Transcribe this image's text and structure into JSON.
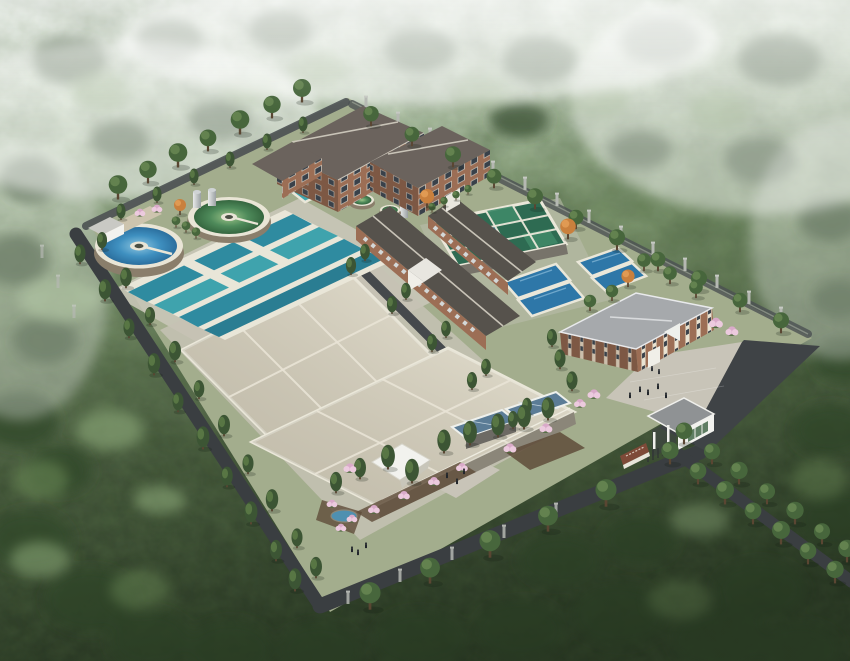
{
  "scene": {
    "description": "Aerial 3D architectural rendering of a water treatment plant campus with circular clarifiers, rectangular treatment basins, covered sedimentation tanks, administration buildings and an entrance gate, surrounded by misty forested hills",
    "elements": {
      "clarifier_blue": "circular clarifier tank with blue water",
      "clarifier_green": "circular clarifier tank with green water",
      "teal_basins": "open rectangular treatment basins with teal water",
      "covered_basins": "large beige-roofed covered basins",
      "filter_grid": "filter basin grid with green water cells",
      "pool_basins": "small rectangular basins with blue water",
      "main_building": "three-storey brick process building",
      "annex_building": "two-storey brick annex",
      "long_buildings": "long gable-roofed process buildings",
      "admin_building": "two-storey brick administration building with hip roof",
      "gatehouse": "white entrance gatehouse",
      "gate_sign": "brown entrance sign wall",
      "white_canopy": "small white canopy structure",
      "perimeter_fence": "concrete post perimeter fence",
      "roads": "dark asphalt perimeter and access roads",
      "forest": "surrounding forested hillside with mist"
    }
  },
  "colors": {
    "haze": "#ecf2ec",
    "forest_top": "#c7d7c0",
    "forest_mid": "#7e9670",
    "forest_dark": "#44553b",
    "forest_deep": "#2e3d28",
    "canopy_dark": "#33492a",
    "canopy_light": "#6d8c58",
    "meadow": "#93b07f",
    "mist": "#ffffff",
    "ground": "#a3ad8d",
    "apron": "#c9c6b8",
    "road": "#3a3e41",
    "parking": "#3f4346",
    "plaza": "#c8c4b8",
    "water_teal": "#2f8ba0",
    "water_teal2": "#3fa3ad",
    "water_deep": "#2a7d92",
    "pool_blue": "#2e77a8",
    "steel_blue": "#5b7c96",
    "pond": "#4f90b0",
    "grid_green": "#2e6b52",
    "cell_hi": "#3f8a68",
    "cell_teal": "#35788a",
    "clar_blue_light": "#8ec6e0",
    "clar_blue": "#3f90c0",
    "clar_blue_deep": "#2b6f9e",
    "clar_green_light": "#9cc488",
    "clar_green": "#4e8a5a",
    "clar_green_deep": "#35663f",
    "rim": "#e9e5d6",
    "beige": "#d8d2c0",
    "beige_wall": "#8b8679",
    "roof_dark": "#56524c",
    "roof_main": "#6b635d",
    "brick": "#9c6e55",
    "brick_dark": "#7d5844",
    "window": "#39414a",
    "cream": "#e9e3d2",
    "admin_roof": "#a6a9ac",
    "white": "#f2f2ee",
    "gate_roof": "#8f9294",
    "sign": "#7e4a38",
    "fencepost": "#b5b8b2",
    "tank_wall": "#8a7e6b",
    "silo": "#cfd3d5",
    "conifer": "#3c5534",
    "conifer_hi": "#5d7c48",
    "tree_round": "#47663c",
    "tree_hi": "#688752",
    "autumn": "#c9803d",
    "autumn_hi": "#e29c55",
    "blossom": "#d9aac9",
    "blossom_hi": "#eccade",
    "mulch": "#5f4c3a",
    "people": "#23272c",
    "wall_shade": "#77736a"
  }
}
